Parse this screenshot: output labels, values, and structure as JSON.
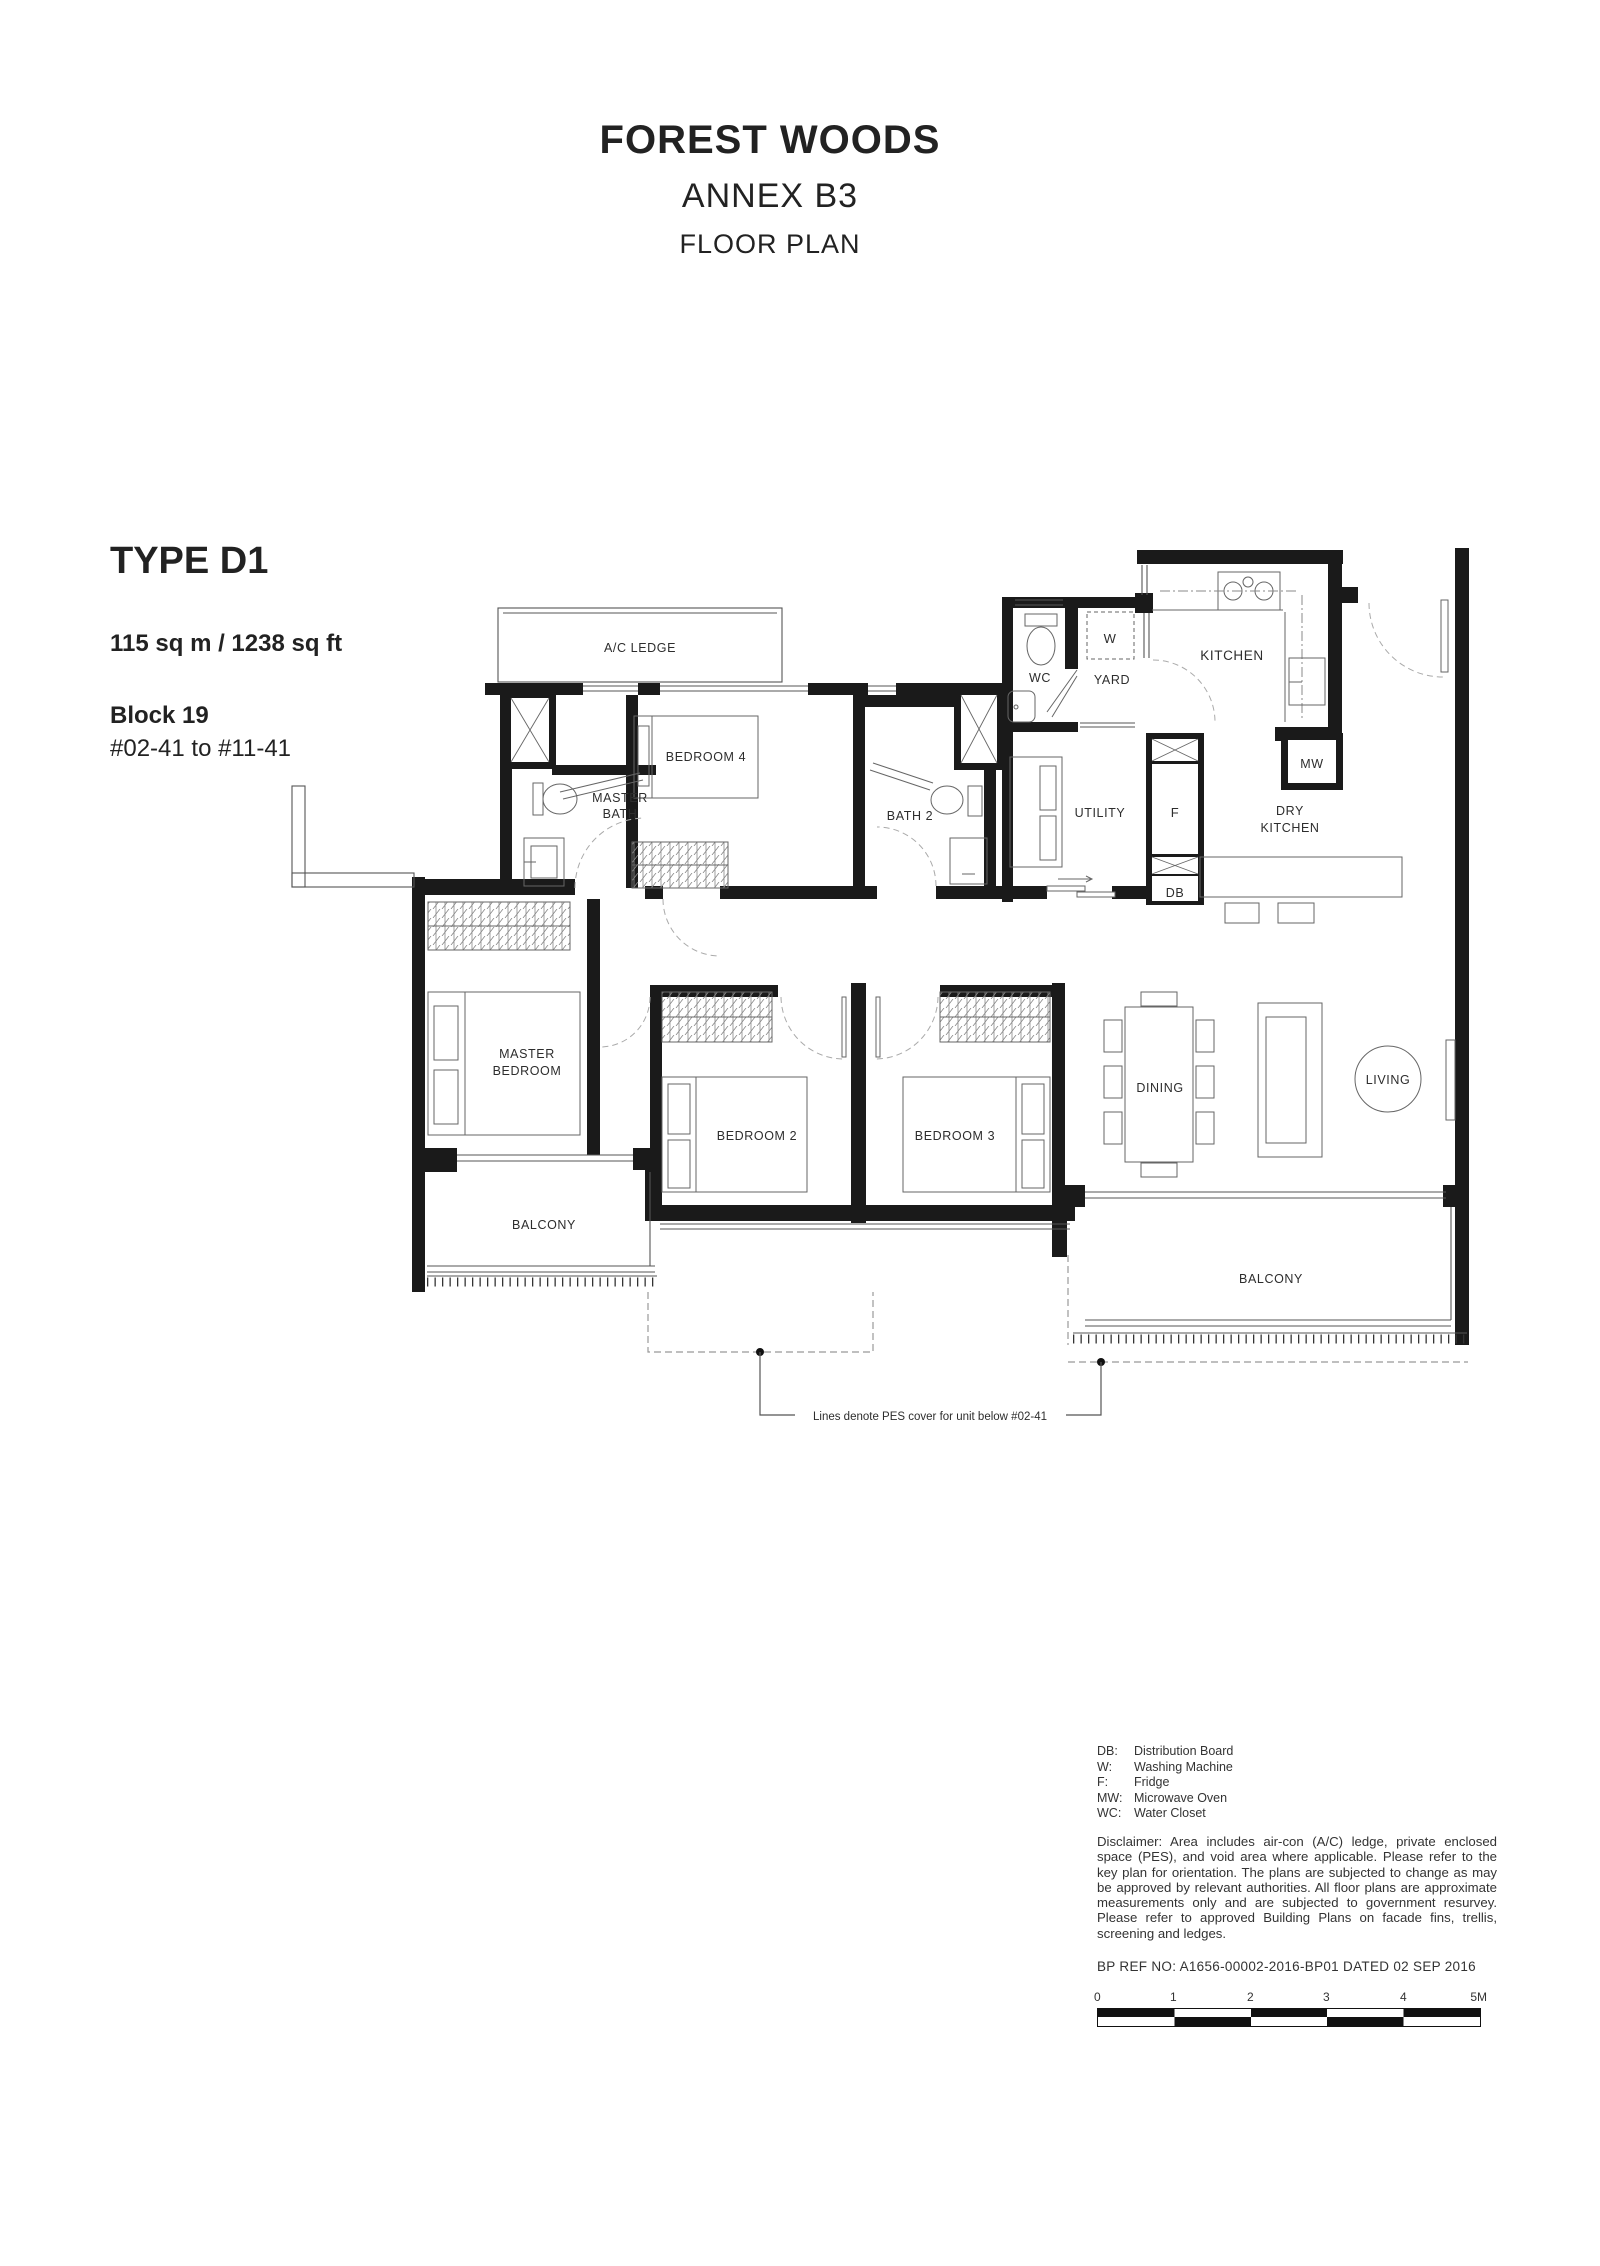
{
  "title": {
    "project": "FOREST WOODS",
    "annex": "ANNEX B3",
    "doc": "FLOOR PLAN"
  },
  "unit": {
    "type": "TYPE D1",
    "area": "115 sq m / 1238 sq ft",
    "block": "Block 19",
    "units": "#02-41 to #11-41"
  },
  "plan": {
    "labels": {
      "ac_ledge": "A/C LEDGE",
      "master_bath_1": "MASTER",
      "master_bath_2": "BATH",
      "bedroom4": "BEDROOM 4",
      "bath2": "BATH 2",
      "wc": "WC",
      "yard": "YARD",
      "washer": "W",
      "kitchen": "KITCHEN",
      "utility": "UTILITY",
      "fridge": "F",
      "dry_kitchen_1": "DRY",
      "dry_kitchen_2": "KITCHEN",
      "microwave": "MW",
      "db": "DB",
      "master_bedroom_1": "MASTER",
      "master_bedroom_2": "BEDROOM",
      "bedroom2": "BEDROOM 2",
      "bedroom3": "BEDROOM 3",
      "dining": "DINING",
      "living": "LIVING",
      "balcony_left": "BALCONY",
      "balcony_right": "BALCONY"
    },
    "note": "Lines denote PES cover for unit below #02-41"
  },
  "legend": {
    "items": [
      {
        "abbr": "DB:",
        "label": "Distribution Board"
      },
      {
        "abbr": "W:",
        "label": "Washing Machine"
      },
      {
        "abbr": "F:",
        "label": "Fridge"
      },
      {
        "abbr": "MW:",
        "label": "Microwave Oven"
      },
      {
        "abbr": "WC:",
        "label": "Water Closet"
      }
    ]
  },
  "disclaimer": "Disclaimer: Area includes air-con (A/C) ledge, private enclosed space (PES), and void area where applicable.  Please refer to the key plan for orientation.  The plans are subjected to change as may be approved by relevant authorities.  All floor plans are approximate measurements only and are subjected to government resurvey. Please refer to approved Building Plans on facade fins, trellis, screening and ledges.",
  "bp_ref": "BP REF NO:  A1656-00002-2016-BP01  DATED 02 SEP 2016",
  "scale_bar": {
    "ticks": [
      "0",
      "1",
      "2",
      "3",
      "4",
      "5M"
    ]
  },
  "colors": {
    "ink": "#1a1a1a",
    "text": "#333333"
  }
}
